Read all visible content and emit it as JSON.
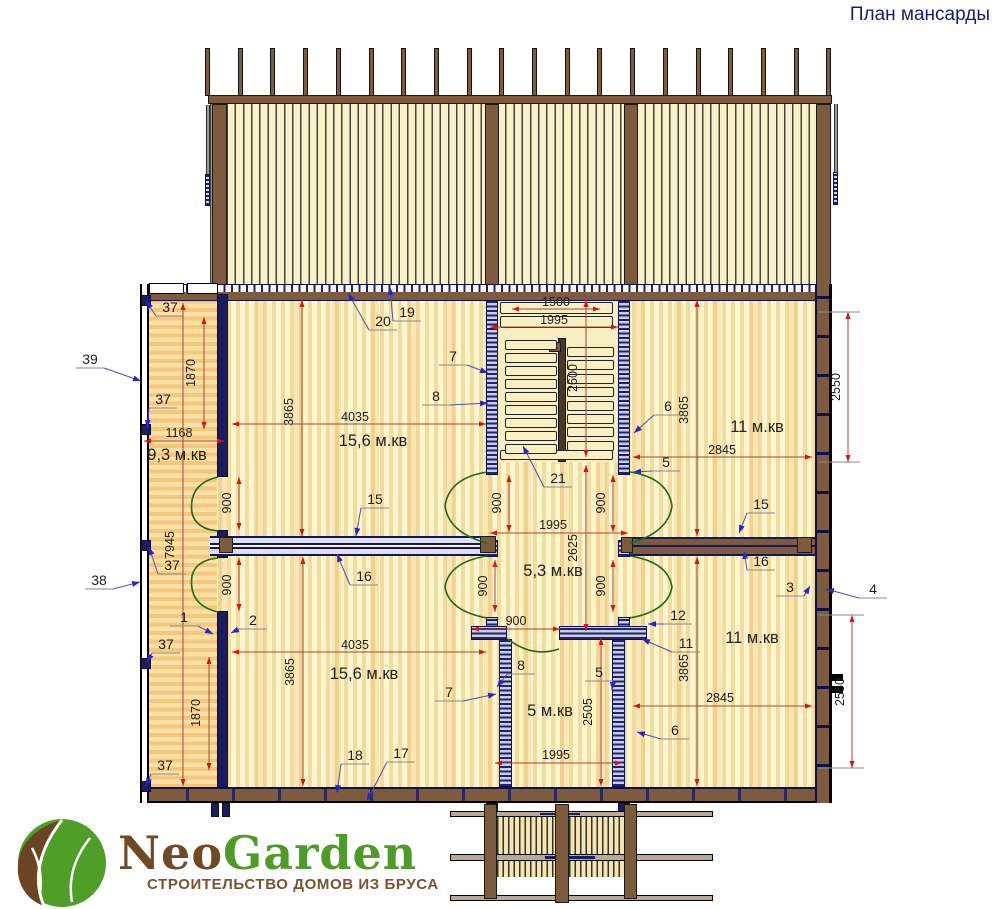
{
  "title": "План мансарды",
  "logo": {
    "name_part1": "Neo",
    "name_part2": "Garden",
    "tagline": "СТРОИТЕЛЬСТВО ДОМОВ ИЗ БРУСА"
  },
  "colors": {
    "title": "#1b1b70",
    "dim_line": "#a04a3a",
    "dim_arrow": "#e01010",
    "leader": "#5050aa",
    "leader_arrow": "#2525c8",
    "door": "#1a6b1a",
    "label": "#1d1d1d",
    "shelf": "#8a8a8a",
    "wood": "#7d5b3c",
    "navy": "#16165a",
    "logo_brown": "#6f4a22",
    "logo_green": "#4e9c27",
    "tagline_brown": "#7a5230"
  },
  "roof": {
    "rafters": 20,
    "start_x": 208,
    "spacing": 32.7,
    "extra_rafter_x": 836
  },
  "stairs": {
    "left_treads": 9,
    "right_treads": 8
  },
  "rooms": [
    {
      "label": "9,3 м.кв",
      "x": 177,
      "y": 455
    },
    {
      "label": "15,6 м.кв",
      "x": 373,
      "y": 441
    },
    {
      "label": "11 м.кв",
      "x": 757,
      "y": 427
    },
    {
      "label": "5,3 м.кв",
      "x": 553,
      "y": 571
    },
    {
      "label": "15,6 м.кв",
      "x": 364,
      "y": 674
    },
    {
      "label": "5 м.кв",
      "x": 550,
      "y": 711
    },
    {
      "label": "11 м.кв",
      "x": 752,
      "y": 638
    }
  ],
  "annotations": {
    "dimensions": [
      {
        "label": "1500",
        "x1": 512,
        "y1": 309,
        "x2": 600,
        "y2": 309,
        "lx": 556,
        "ly": 302,
        "rot": 0
      },
      {
        "label": "1995",
        "x1": 490,
        "y1": 327,
        "x2": 618,
        "y2": 327,
        "lx": 554,
        "ly": 320,
        "rot": 0
      },
      {
        "label": "2600",
        "x1": 586,
        "y1": 300,
        "x2": 586,
        "y2": 457,
        "lx": 577,
        "ly": 378,
        "rot": -90
      },
      {
        "label": "1870",
        "x1": 204,
        "y1": 317,
        "x2": 204,
        "y2": 429,
        "lx": 195,
        "ly": 373,
        "rot": -90
      },
      {
        "label": "1168",
        "x1": 144,
        "y1": 441,
        "x2": 224,
        "y2": 441,
        "lx": 179,
        "ly": 433,
        "rot": 0
      },
      {
        "label": "3865",
        "x1": 302,
        "y1": 300,
        "x2": 302,
        "y2": 536,
        "lx": 293,
        "ly": 412,
        "rot": -90
      },
      {
        "label": "4035",
        "x1": 232,
        "y1": 424,
        "x2": 486,
        "y2": 424,
        "lx": 355,
        "ly": 417,
        "rot": 0
      },
      {
        "label": "3865",
        "x1": 697,
        "y1": 300,
        "x2": 697,
        "y2": 536,
        "lx": 688,
        "ly": 410,
        "rot": -90
      },
      {
        "label": "2845",
        "x1": 633,
        "y1": 457,
        "x2": 812,
        "y2": 457,
        "lx": 722,
        "ly": 450,
        "rot": 0
      },
      {
        "label": "2550",
        "x1": 848,
        "y1": 312,
        "x2": 848,
        "y2": 462,
        "lx": 840,
        "ly": 387,
        "rot": -90
      },
      {
        "label": "900",
        "x1": 239,
        "y1": 477,
        "x2": 239,
        "y2": 530,
        "lx": 231,
        "ly": 503,
        "rot": -90
      },
      {
        "label": "900",
        "x1": 239,
        "y1": 558,
        "x2": 239,
        "y2": 611,
        "lx": 231,
        "ly": 585,
        "rot": -90
      },
      {
        "label": "900",
        "x1": 509,
        "y1": 475,
        "x2": 509,
        "y2": 532,
        "lx": 501,
        "ly": 503,
        "rot": -90
      },
      {
        "label": "900",
        "x1": 495,
        "y1": 560,
        "x2": 495,
        "y2": 612,
        "lx": 487,
        "ly": 586,
        "rot": -90
      },
      {
        "label": "900",
        "x1": 613,
        "y1": 475,
        "x2": 613,
        "y2": 532,
        "lx": 605,
        "ly": 503,
        "rot": -90
      },
      {
        "label": "900",
        "x1": 613,
        "y1": 560,
        "x2": 613,
        "y2": 612,
        "lx": 605,
        "ly": 586,
        "rot": -90
      },
      {
        "label": "900",
        "x1": 472,
        "y1": 629,
        "x2": 560,
        "y2": 629,
        "lx": 516,
        "ly": 621,
        "rot": 0
      },
      {
        "label": "1995",
        "x1": 490,
        "y1": 533,
        "x2": 628,
        "y2": 533,
        "lx": 553,
        "ly": 525,
        "rot": 0
      },
      {
        "label": "2625",
        "x1": 586,
        "y1": 465,
        "x2": 586,
        "y2": 631,
        "lx": 577,
        "ly": 548,
        "rot": -90
      },
      {
        "label": "7945",
        "x1": 183,
        "y1": 303,
        "x2": 183,
        "y2": 786,
        "lx": 174,
        "ly": 545,
        "rot": -90
      },
      {
        "label": "1870",
        "x1": 209,
        "y1": 657,
        "x2": 209,
        "y2": 770,
        "lx": 200,
        "ly": 713,
        "rot": -90
      },
      {
        "label": "3865",
        "x1": 303,
        "y1": 557,
        "x2": 303,
        "y2": 786,
        "lx": 294,
        "ly": 672,
        "rot": -90
      },
      {
        "label": "4035",
        "x1": 232,
        "y1": 652,
        "x2": 486,
        "y2": 652,
        "lx": 355,
        "ly": 645,
        "rot": 0
      },
      {
        "label": "3865",
        "x1": 697,
        "y1": 557,
        "x2": 697,
        "y2": 786,
        "lx": 688,
        "ly": 668,
        "rot": -90
      },
      {
        "label": "2845",
        "x1": 633,
        "y1": 706,
        "x2": 812,
        "y2": 706,
        "lx": 720,
        "ly": 698,
        "rot": 0
      },
      {
        "label": "2550",
        "x1": 852,
        "y1": 615,
        "x2": 852,
        "y2": 768,
        "lx": 844,
        "ly": 692,
        "rot": -90
      },
      {
        "label": "2505",
        "x1": 601,
        "y1": 638,
        "x2": 601,
        "y2": 786,
        "lx": 592,
        "ly": 712,
        "rot": -90
      },
      {
        "label": "1995",
        "x1": 495,
        "y1": 763,
        "x2": 622,
        "y2": 763,
        "lx": 556,
        "ly": 755,
        "rot": 0
      }
    ],
    "callouts": [
      {
        "label": "37",
        "lx": 170,
        "ly": 308,
        "tx": 146,
        "ty": 301
      },
      {
        "label": "37",
        "lx": 163,
        "ly": 400,
        "tx": 147,
        "ty": 428
      },
      {
        "label": "37",
        "lx": 172,
        "ly": 566,
        "tx": 149,
        "ty": 547
      },
      {
        "label": "37",
        "lx": 166,
        "ly": 645,
        "tx": 147,
        "ty": 662
      },
      {
        "label": "37",
        "lx": 165,
        "ly": 766,
        "tx": 146,
        "ty": 786
      },
      {
        "label": "39",
        "lx": 90,
        "ly": 360,
        "tx": 141,
        "ty": 381
      },
      {
        "label": "38",
        "lx": 99,
        "ly": 581,
        "tx": 140,
        "ty": 582
      },
      {
        "label": "1",
        "lx": 184,
        "ly": 618,
        "tx": 213,
        "ty": 634
      },
      {
        "label": "2",
        "lx": 253,
        "ly": 621,
        "tx": 231,
        "ty": 633
      },
      {
        "label": "19",
        "lx": 407,
        "ly": 313,
        "tx": 390,
        "ty": 287
      },
      {
        "label": "20",
        "lx": 383,
        "ly": 322,
        "tx": 348,
        "ty": 293
      },
      {
        "label": "21",
        "lx": 558,
        "ly": 479,
        "tx": 523,
        "ty": 446
      },
      {
        "label": "7",
        "lx": 453,
        "ly": 357,
        "tx": 488,
        "ty": 373
      },
      {
        "label": "8",
        "lx": 436,
        "ly": 397,
        "tx": 488,
        "ty": 403
      },
      {
        "label": "6",
        "lx": 668,
        "ly": 407,
        "tx": 634,
        "ty": 433
      },
      {
        "label": "5",
        "lx": 666,
        "ly": 463,
        "tx": 633,
        "ty": 472
      },
      {
        "label": "15",
        "lx": 375,
        "ly": 500,
        "tx": 356,
        "ty": 536
      },
      {
        "label": "16",
        "lx": 364,
        "ly": 577,
        "tx": 337,
        "ty": 554
      },
      {
        "label": "15",
        "lx": 761,
        "ly": 505,
        "tx": 739,
        "ty": 533
      },
      {
        "label": "16",
        "lx": 761,
        "ly": 562,
        "tx": 744,
        "ty": 551
      },
      {
        "label": "3",
        "lx": 790,
        "ly": 588,
        "tx": 810,
        "ty": 586
      },
      {
        "label": "4",
        "lx": 873,
        "ly": 590,
        "tx": 826,
        "ty": 589
      },
      {
        "label": "12",
        "lx": 678,
        "ly": 616,
        "tx": 648,
        "ty": 624
      },
      {
        "label": "11",
        "lx": 686,
        "ly": 644,
        "tx": 642,
        "ty": 639
      },
      {
        "label": "8",
        "lx": 521,
        "ly": 666,
        "tx": 497,
        "ty": 687
      },
      {
        "label": "7",
        "lx": 449,
        "ly": 693,
        "tx": 496,
        "ty": 694
      },
      {
        "label": "5",
        "lx": 599,
        "ly": 673,
        "tx": 612,
        "ty": 690
      },
      {
        "label": "6",
        "lx": 675,
        "ly": 731,
        "tx": 637,
        "ty": 732
      },
      {
        "label": "18",
        "lx": 355,
        "ly": 756,
        "tx": 337,
        "ty": 793
      },
      {
        "label": "17",
        "lx": 401,
        "ly": 754,
        "tx": 367,
        "ty": 801
      }
    ],
    "extension_lines": [
      [
        818,
        312,
        860,
        312
      ],
      [
        818,
        462,
        860,
        462
      ],
      [
        818,
        615,
        864,
        615
      ],
      [
        818,
        768,
        864,
        768
      ]
    ],
    "doors": [
      {
        "path": "M218,477 Q188,484 192,513 Q196,529 218,531"
      },
      {
        "path": "M218,612 Q188,605 192,576 Q196,560 218,558"
      },
      {
        "path": "M487,472 Q449,478 445,506 Q449,533 487,543"
      },
      {
        "path": "M630,472 Q668,478 672,506 Q668,533 630,543"
      },
      {
        "path": "M487,556 Q449,562 445,587 Q449,611 487,618"
      },
      {
        "path": "M630,556 Q668,562 672,587 Q668,611 630,618"
      },
      {
        "path": "M508,639 Q532,658 559,649"
      }
    ]
  }
}
